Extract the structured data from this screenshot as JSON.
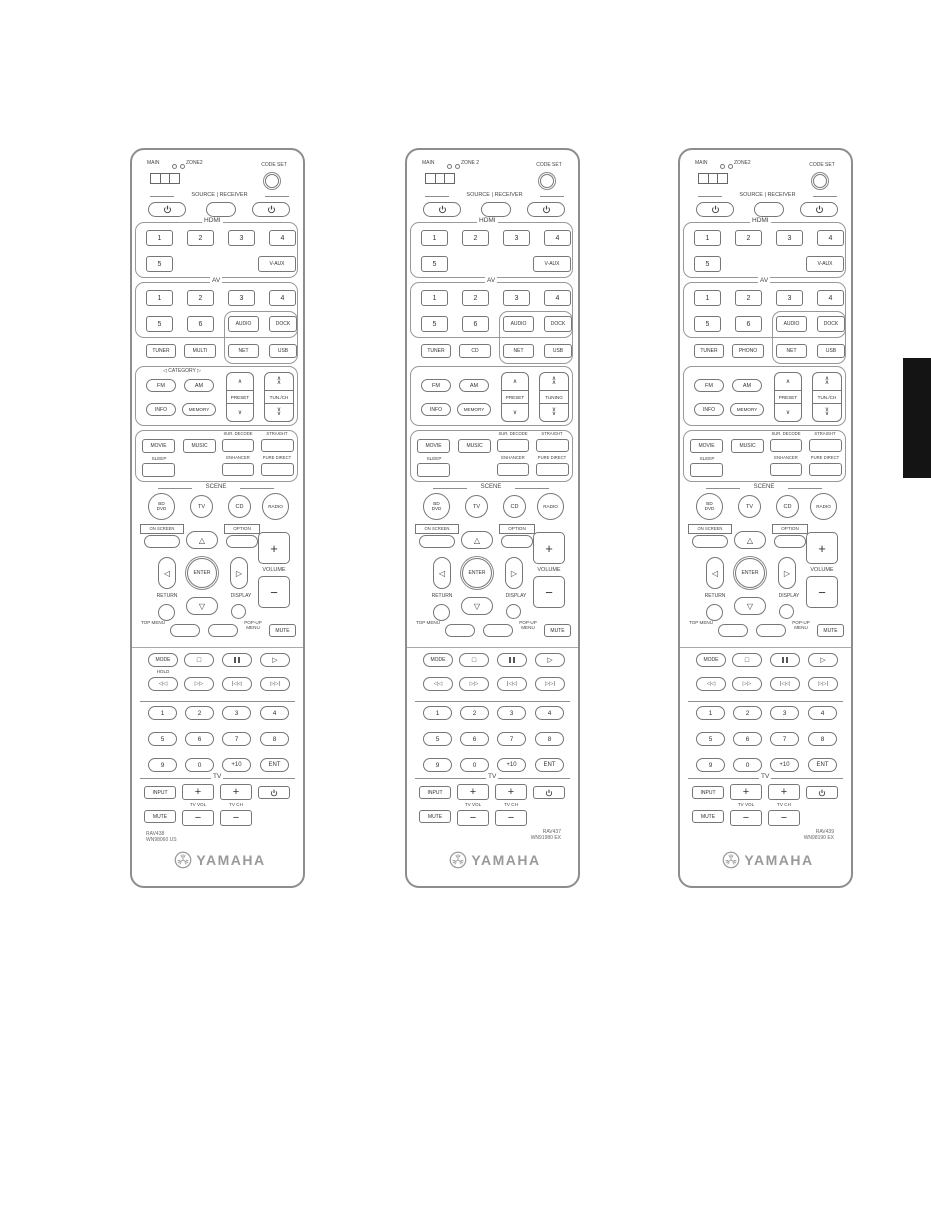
{
  "page": {
    "background": "#ffffff",
    "tab_color": "#141414"
  },
  "icons": {
    "up": "△",
    "down": "▽",
    "left": "◁",
    "right": "▷",
    "stop": "□",
    "play": "▷",
    "rew": "◁◁",
    "ff": "▷▷",
    "skip_back": "|◁◁",
    "skip_fwd": "▷▷|",
    "chev_up": "∧",
    "chev_down": "∨",
    "plus": "+",
    "minus": "−"
  },
  "remotes": [
    {
      "switch_main": "MAIN",
      "switch_zone": "ZONE2",
      "code_set": "CODE SET",
      "source_receiver": "SOURCE | RECEIVER",
      "hdmi": {
        "label": "HDMI",
        "b1": "1",
        "b2": "2",
        "b3": "3",
        "b4": "4",
        "b5": "5",
        "vaux": "V-AUX"
      },
      "av": {
        "label": "AV",
        "b1": "1",
        "b2": "2",
        "b3": "3",
        "b4": "4",
        "b5": "5",
        "b6": "6",
        "audio": "AUDIO",
        "dock": "DOCK"
      },
      "inputs": {
        "tuner": "TUNER",
        "second": "MULTI",
        "net": "NET",
        "usb": "USB"
      },
      "tuner": {
        "category": "◁ CATEGORY ▷",
        "fm": "FM",
        "am": "AM",
        "info": "INFO",
        "memory": "MEMORY",
        "preset": "PRESET",
        "tuning": "TUN./CH"
      },
      "sound": {
        "movie": "MOVIE",
        "music": "MUSIC",
        "sur_decode": "SUR. DECODE",
        "straight": "STRAIGHT",
        "sleep": "SLEEP",
        "enhancer": "ENHANCER",
        "pure_direct": "PURE DIRECT"
      },
      "scene": {
        "label": "SCENE",
        "s1a": "BD",
        "s1b": "DVD",
        "s2": "TV",
        "s3": "CD",
        "s4": "RADIO"
      },
      "onscreen": "ON SCREEN",
      "option": "OPTION",
      "enter": "ENTER",
      "return": "RETURN",
      "display": "DISPLAY",
      "volume": "VOLUME",
      "top_menu": "TOP MENU",
      "popup_menu": "POP-UP MENU",
      "mute": "MUTE",
      "mode": "MODE",
      "hold": "HOLD",
      "digits": [
        "1",
        "2",
        "3",
        "4",
        "5",
        "6",
        "7",
        "8",
        "9",
        "0",
        "+10",
        "ENT"
      ],
      "tv": {
        "label": "TV",
        "input": "INPUT",
        "vol": "TV VOL",
        "ch": "TV CH",
        "mute": "MUTE"
      },
      "model": [
        "RAV438",
        "WN98060 US"
      ],
      "model_side": "left",
      "brand": "YAMAHA"
    },
    {
      "switch_main": "MAIN",
      "switch_zone": "ZONE 2",
      "code_set": "CODE SET",
      "source_receiver": "SOURCE | RECEIVER",
      "hdmi": {
        "label": "HDMI",
        "b1": "1",
        "b2": "2",
        "b3": "3",
        "b4": "4",
        "b5": "5",
        "vaux": "V-AUX"
      },
      "av": {
        "label": "AV",
        "b1": "1",
        "b2": "2",
        "b3": "3",
        "b4": "4",
        "b5": "5",
        "b6": "6",
        "audio": "AUDIO",
        "dock": "DOCK"
      },
      "inputs": {
        "tuner": "TUNER",
        "second": "CD",
        "net": "NET",
        "usb": "USB"
      },
      "tuner": {
        "category": "",
        "fm": "FM",
        "am": "AM",
        "info": "INFO",
        "memory": "MEMORY",
        "preset": "PRESET",
        "tuning": "TUNING"
      },
      "sound": {
        "movie": "MOVIE",
        "music": "MUSIC",
        "sur_decode": "SUR. DECODE",
        "straight": "STRAIGHT",
        "sleep": "SLEEP",
        "enhancer": "ENHANCER",
        "pure_direct": "PURE DIRECT"
      },
      "scene": {
        "label": "SCENE",
        "s1a": "BD",
        "s1b": "DVD",
        "s2": "TV",
        "s3": "CD",
        "s4": "RADIO"
      },
      "onscreen": "ON SCREEN",
      "option": "OPTION",
      "enter": "ENTER",
      "return": "RETURN",
      "display": "DISPLAY",
      "volume": "VOLUME",
      "top_menu": "TOP MENU",
      "popup_menu": "POP-UP MENU",
      "mute": "MUTE",
      "mode": "MODE",
      "hold": "",
      "digits": [
        "1",
        "2",
        "3",
        "4",
        "5",
        "6",
        "7",
        "8",
        "9",
        "0",
        "+10",
        "ENT"
      ],
      "tv": {
        "label": "TV",
        "input": "INPUT",
        "vol": "TV VOL",
        "ch": "TV CH",
        "mute": "MUTE"
      },
      "model": [
        "RAV437",
        "WN91980 EX"
      ],
      "model_side": "right",
      "brand": "YAMAHA"
    },
    {
      "switch_main": "MAIN",
      "switch_zone": "ZONE2",
      "code_set": "CODE SET",
      "source_receiver": "SOURCE | RECEIVER",
      "hdmi": {
        "label": "HDMI",
        "b1": "1",
        "b2": "2",
        "b3": "3",
        "b4": "4",
        "b5": "5",
        "vaux": "V-AUX"
      },
      "av": {
        "label": "AV",
        "b1": "1",
        "b2": "2",
        "b3": "3",
        "b4": "4",
        "b5": "5",
        "b6": "6",
        "audio": "AUDIO",
        "dock": "DOCK"
      },
      "inputs": {
        "tuner": "TUNER",
        "second": "PHONO",
        "net": "NET",
        "usb": "USB"
      },
      "tuner": {
        "category": "",
        "fm": "FM",
        "am": "AM",
        "info": "INFO",
        "memory": "MEMORY",
        "preset": "PRESET",
        "tuning": "TUN./CH"
      },
      "sound": {
        "movie": "MOVIE",
        "music": "MUSIC",
        "sur_decode": "SUR. DECODE",
        "straight": "STRAIGHT",
        "sleep": "SLEEP",
        "enhancer": "ENHANCER",
        "pure_direct": "PURE DIRECT"
      },
      "scene": {
        "label": "SCENE",
        "s1a": "BD",
        "s1b": "DVD",
        "s2": "TV",
        "s3": "CD",
        "s4": "RADIO"
      },
      "onscreen": "ON SCREEN",
      "option": "OPTION",
      "enter": "ENTER",
      "return": "RETURN",
      "display": "DISPLAY",
      "volume": "VOLUME",
      "top_menu": "TOP MENU",
      "popup_menu": "POP-UP MENU",
      "mute": "MUTE",
      "mode": "MODE",
      "hold": "",
      "digits": [
        "1",
        "2",
        "3",
        "4",
        "5",
        "6",
        "7",
        "8",
        "9",
        "0",
        "+10",
        "ENT"
      ],
      "tv": {
        "label": "TV",
        "input": "INPUT",
        "vol": "TV VOL",
        "ch": "TV CH",
        "mute": "MUTE"
      },
      "model": [
        "RAV439",
        "WN98190 EX"
      ],
      "model_side": "right",
      "brand": "YAMAHA"
    }
  ]
}
